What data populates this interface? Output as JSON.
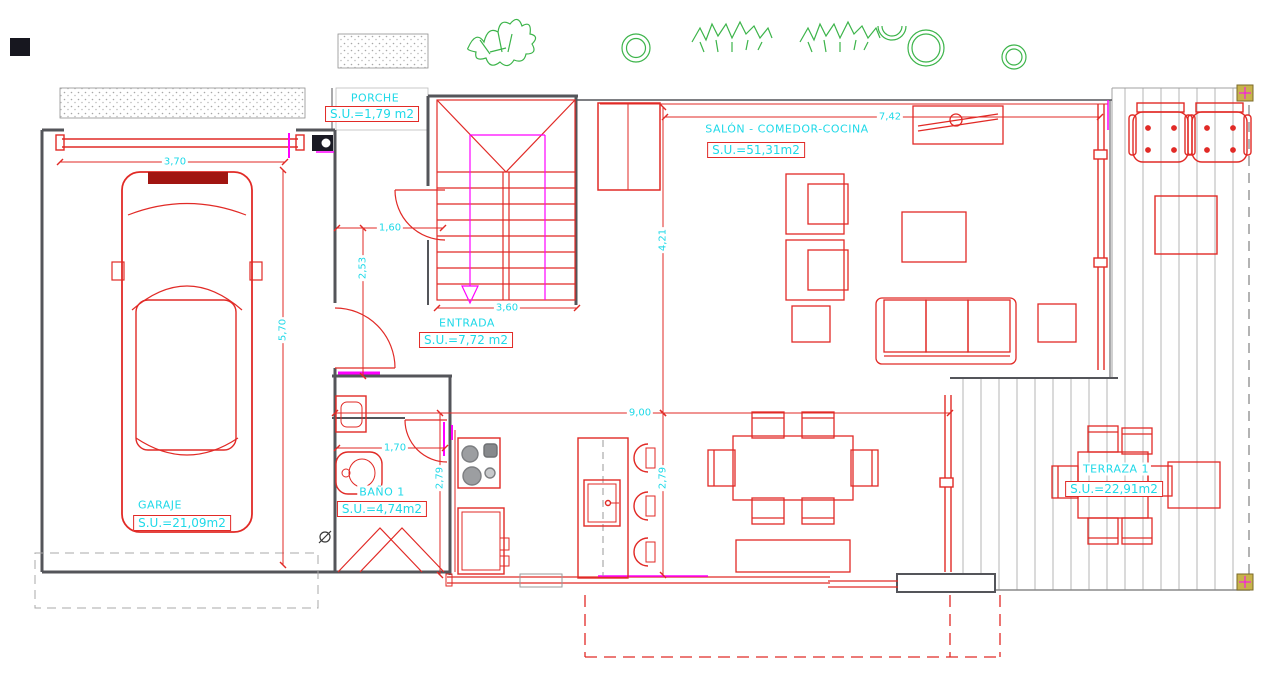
{
  "drawing": {
    "type": "architectural-floor-plan"
  },
  "colors": {
    "line_red": "#e12a26",
    "text_cyan": "#1fd9e8",
    "magenta": "#ff00ff",
    "plant_green": "#3cb44a",
    "wall_gray": "#54555a",
    "deck_gray": "#b4b4b4",
    "marker_yellow": "#c8b24c",
    "appliance_gray": "#9c9ea1"
  },
  "rooms": {
    "porche": {
      "name": "PORCHE",
      "area": "S.U.=1,79 m2"
    },
    "salon": {
      "name": "SALÓN - COMEDOR-COCINA",
      "area": "S.U.=51,31m2"
    },
    "entrada": {
      "name": "ENTRADA",
      "area": "S.U.=7,72 m2"
    },
    "garaje": {
      "name": "GARAJE",
      "area": "S.U.=21,09m2"
    },
    "bano": {
      "name": "BAÑO 1",
      "area": "S.U.=4,74m2"
    },
    "terraza": {
      "name": "TERRAZA 1",
      "area": "S.U.=22,91m2"
    }
  },
  "dimensions": {
    "garage_width": "3,70",
    "garage_depth": "5,70",
    "hall_width": "1,60",
    "hall_depth": "2,53",
    "stairs_width": "3,60",
    "salon_depth": "4,21",
    "salon_width": "7,42",
    "house_width": "9,00",
    "bath_width": "1,70",
    "kitchen_depth": "2,79",
    "dining_depth": "2,79"
  }
}
